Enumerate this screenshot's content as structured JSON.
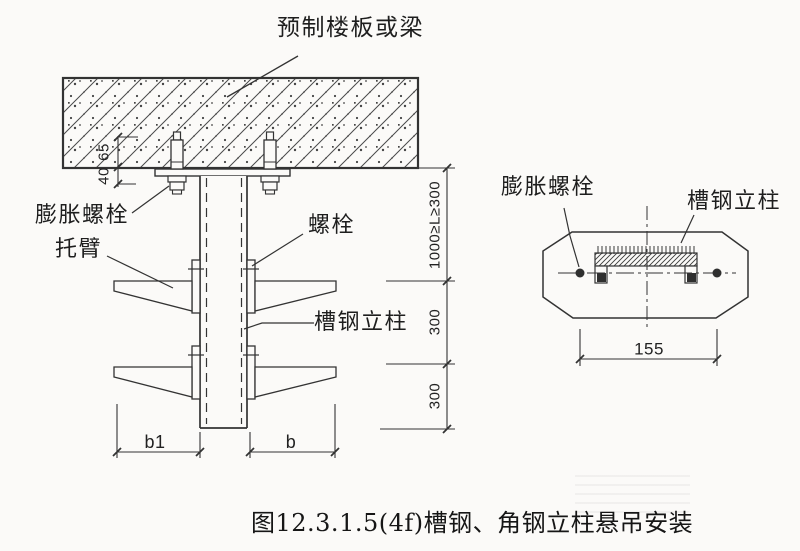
{
  "colors": {
    "background": "#fbfaf8",
    "line": "#333333",
    "text": "#1e1e1e"
  },
  "caption": "图12.3.1.5(4f)槽钢、角钢立柱悬吊安装",
  "left_view": {
    "labels": {
      "slab": "预制楼板或梁",
      "expansion_bolt": "膨胀螺栓",
      "bracket_arm": "托臂",
      "bolt": "螺栓",
      "channel_column": "槽钢立柱"
    },
    "dims": {
      "embed_depth": "65",
      "protrusion": "40",
      "top_spacing": "1000≥L≥300",
      "mid_spacing": "300",
      "bottom_spacing": "300",
      "left_width": "b1",
      "right_width": "b"
    }
  },
  "right_view": {
    "labels": {
      "expansion_bolt": "膨胀螺栓",
      "channel_column": "槽钢立柱"
    },
    "dims": {
      "bolt_spacing": "155"
    }
  }
}
